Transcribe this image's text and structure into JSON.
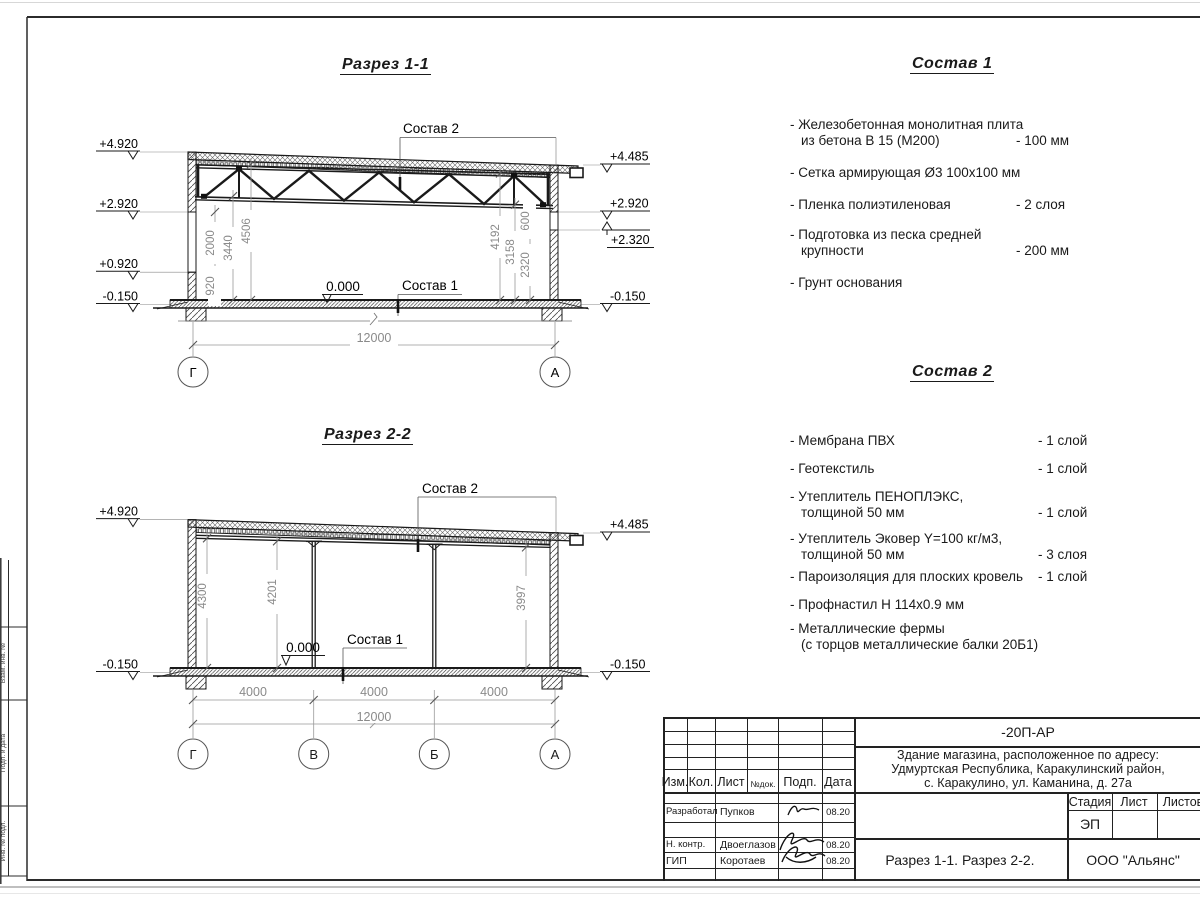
{
  "section1": {
    "title": "Разрез 1-1",
    "sostav2_label": "Состав 2",
    "sostav1_label": "Состав 1",
    "zero_label": "0.000",
    "total_dim": "12000",
    "elev_left": [
      "+4.920",
      "+2.920",
      "+0.920",
      "-0.150"
    ],
    "elev_right": [
      "+4.485",
      "+2.920",
      "+2.320",
      "-0.150"
    ],
    "dims_left": [
      "920",
      "2000",
      "3440",
      "4506"
    ],
    "dims_right": [
      "4192",
      "3158",
      "2320",
      "600"
    ],
    "axes": [
      "Г",
      "А"
    ]
  },
  "section2": {
    "title": "Разрез 2-2",
    "sostav2_label": "Состав 2",
    "sostav1_label": "Состав 1",
    "zero_label": "0.000",
    "total_dim": "12000",
    "span_dims": [
      "4000",
      "4000",
      "4000"
    ],
    "elev_left": [
      "+4.920",
      "-0.150"
    ],
    "elev_right": [
      "+4.485",
      "-0.150"
    ],
    "dims": [
      "4300",
      "4201",
      "3997"
    ],
    "axes": [
      "Г",
      "В",
      "Б",
      "А"
    ]
  },
  "sostav1": {
    "title": "Состав 1",
    "items": [
      {
        "l1": "- Железобетонная  монолитная плита",
        "l2": "из бетона В 15 (М200)",
        "v": "- 100 мм"
      },
      {
        "l1": "- Сетка армирующая Ø3 100х100 мм"
      },
      {
        "l1": "- Пленка полиэтиленовая",
        "v": "-  2 слоя"
      },
      {
        "l1": "- Подготовка из песка средней",
        "l2": "крупности",
        "v": "- 200 мм"
      },
      {
        "l1": "- Грунт основания"
      }
    ]
  },
  "sostav2": {
    "title": "Состав 2",
    "items": [
      {
        "l1": "- Мембрана ПВХ",
        "v": "- 1 слой"
      },
      {
        "l1": "- Геотекстиль",
        "v": "- 1 слой"
      },
      {
        "l1": "- Утеплитель ПЕНОПЛЭКС,",
        "l2": "толщиной 50 мм",
        "v": "- 1 слой"
      },
      {
        "l1": "- Утеплитель Эковер Y=100 кг/м3,",
        "l2": "толщиной 50 мм",
        "v": "- 3 слоя"
      },
      {
        "l1": "- Пароизоляция для плоских кровель",
        "v": "- 1 слой"
      },
      {
        "l1": "- Профнастил Н 114х0.9 мм"
      },
      {
        "l1": "- Металлические фермы",
        "l2": "(с торцов металлические балки 20Б1)"
      }
    ]
  },
  "titleblock": {
    "doc_code": "-20П-АР",
    "address_l1": "Здание магазина, расположенное по адресу:",
    "address_l2": "Удмуртская Республика, Каракулинский район,",
    "address_l3": "с. Каракулино, ул. Каманина, д. 27а",
    "col_izm": "Изм.",
    "col_kol": "Кол.",
    "col_list": "Лист",
    "col_ndok": "№док.",
    "col_podp": "Подп.",
    "col_data": "Дата",
    "row1_role": "Разработал",
    "row1_name": "Пупков",
    "row1_date": "08.20",
    "row2_role": "Н. контр.",
    "row2_name": "Двоеглазов",
    "row2_date": "08.20",
    "row3_role": "ГИП",
    "row3_name": "Коротаев",
    "row3_date": "08.20",
    "stadia_label": "Стадия",
    "list_label": "Лист",
    "listov_label": "Листов",
    "stadia_value": "ЭП",
    "sheet_title": "Разрез 1-1. Разрез 2-2.",
    "company": "ООО \"Альянс\""
  },
  "side_stamp": {
    "cell1": "Взам. инв. №",
    "cell2": "Подп. и дата",
    "cell3": "Инв. № подл."
  }
}
